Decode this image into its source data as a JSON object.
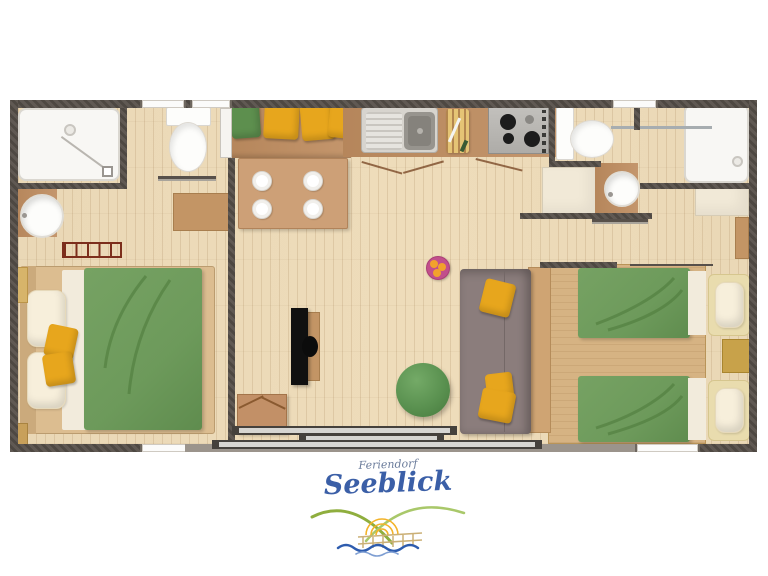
{
  "logo": {
    "brand_top": "Feriendorf",
    "brand_name": "Seeblick"
  },
  "colors": {
    "wall": "#57504a",
    "floor": "#ead8b6",
    "counter": "#bf8d60",
    "table": "#cda077",
    "wood_dark": "#c39565",
    "bed_frame": "#dcbd90",
    "duvet": "#6d9a5b",
    "seam": "#4f7c3c",
    "pillow": "#f7efdb",
    "pillow_trim": "#e9dcae",
    "yellow": "#e7a61d",
    "cushion_green": "#5d8f4e",
    "sofa": "#8b7d7c",
    "console": "#cfa473",
    "pouf": "#5a9150",
    "fruit_pink": "#c24f8b",
    "fruit_orange": "#f2a12c",
    "ceramic": "#f8f7f4",
    "steel": "#d7d4ce",
    "basin_gray": "#97948e",
    "stove": "#b5b3af",
    "radiator": "#7c2e1c",
    "cream": "#f1e9d7",
    "gold": "#c8a24a",
    "glass": "#d6d5d1",
    "frame_dark": "#45413c",
    "logo_blue": "#3b5fa7",
    "logo_gray": "#6b7c9b",
    "logo_green": "#8fae3e",
    "logo_green_light": "#a9c86a",
    "logo_sun": "#f3b32a",
    "logo_pier": "#cbb077",
    "logo_wave": "#2e5cae",
    "logo_wave_light": "#7e9ed2"
  },
  "legend": {
    "rooms": [
      "bedroom-double",
      "shower-room-left",
      "kitchen-dining",
      "living-room",
      "shower-room-right",
      "bedroom-twin"
    ],
    "items": [
      "shower-tray",
      "toilet",
      "washbasin",
      "radiator",
      "wardrobe",
      "double-bed",
      "bench-with-cushions",
      "dining-table-with-plates",
      "kitchen-sink",
      "cutting-board",
      "stove",
      "cabinet",
      "sofa",
      "tv",
      "pouf",
      "fruit-bowl",
      "side-table",
      "twin-beds",
      "nightstand",
      "sliding-patio-door"
    ]
  }
}
